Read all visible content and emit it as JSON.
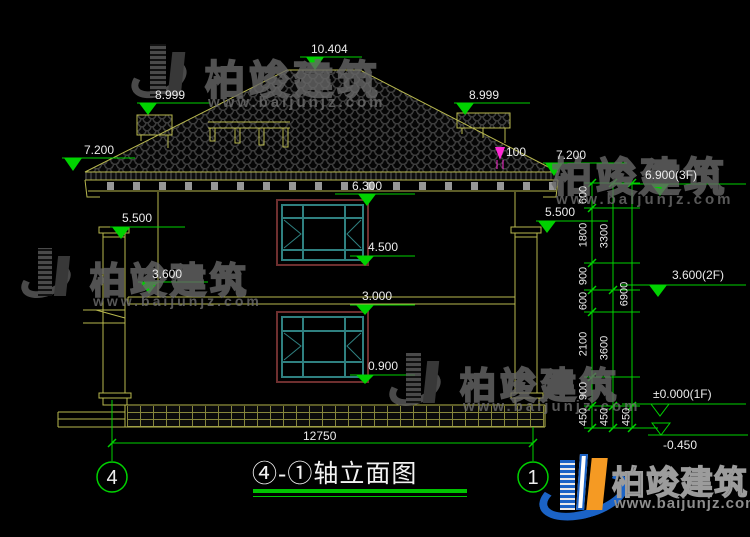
{
  "drawing": {
    "title": "④-①轴立面图",
    "axis_left": "4",
    "axis_right": "1",
    "bottom_dim": "12750",
    "detail_label": "100"
  },
  "elevation_labels": {
    "ridge": "10.404",
    "eave_left_upper": "8.999",
    "eave_right_upper": "8.999",
    "eave_left": "7.200",
    "eave_right": "7.200",
    "capital_left": "5.500",
    "capital_right": "5.500",
    "win2_top": "6.300",
    "win2_sill": "4.500",
    "floor2_left": "3.600",
    "floor2_slab": "3.000",
    "win1_sill": "0.900"
  },
  "floor_markers": {
    "f3": "6.900(3F)",
    "f2": "3.600(2F)",
    "f1": "±0.000(1F)",
    "ground": "-0.450"
  },
  "dim_chains": {
    "inner": [
      "600",
      "1800",
      "900",
      "600",
      "2100",
      "900",
      "450"
    ],
    "middle": [
      "3300",
      "3600",
      "450"
    ],
    "outer": [
      "6900",
      "450"
    ]
  },
  "watermark": {
    "brand": "柏竣建筑",
    "url": "www.baijunjz.com"
  },
  "logo": {
    "brand": "柏竣建筑",
    "url": "www.baijunjz.com"
  },
  "colors": {
    "line_yellow": "#b8b84e",
    "dim_green": "#00d200",
    "window_teal": "#2f8080",
    "window_surround": "#6e2f2f",
    "highlight_magenta": "#ff2ad4",
    "logo_blue": "#1b63c6",
    "logo_orange": "#f59a23",
    "background": "#000000"
  }
}
